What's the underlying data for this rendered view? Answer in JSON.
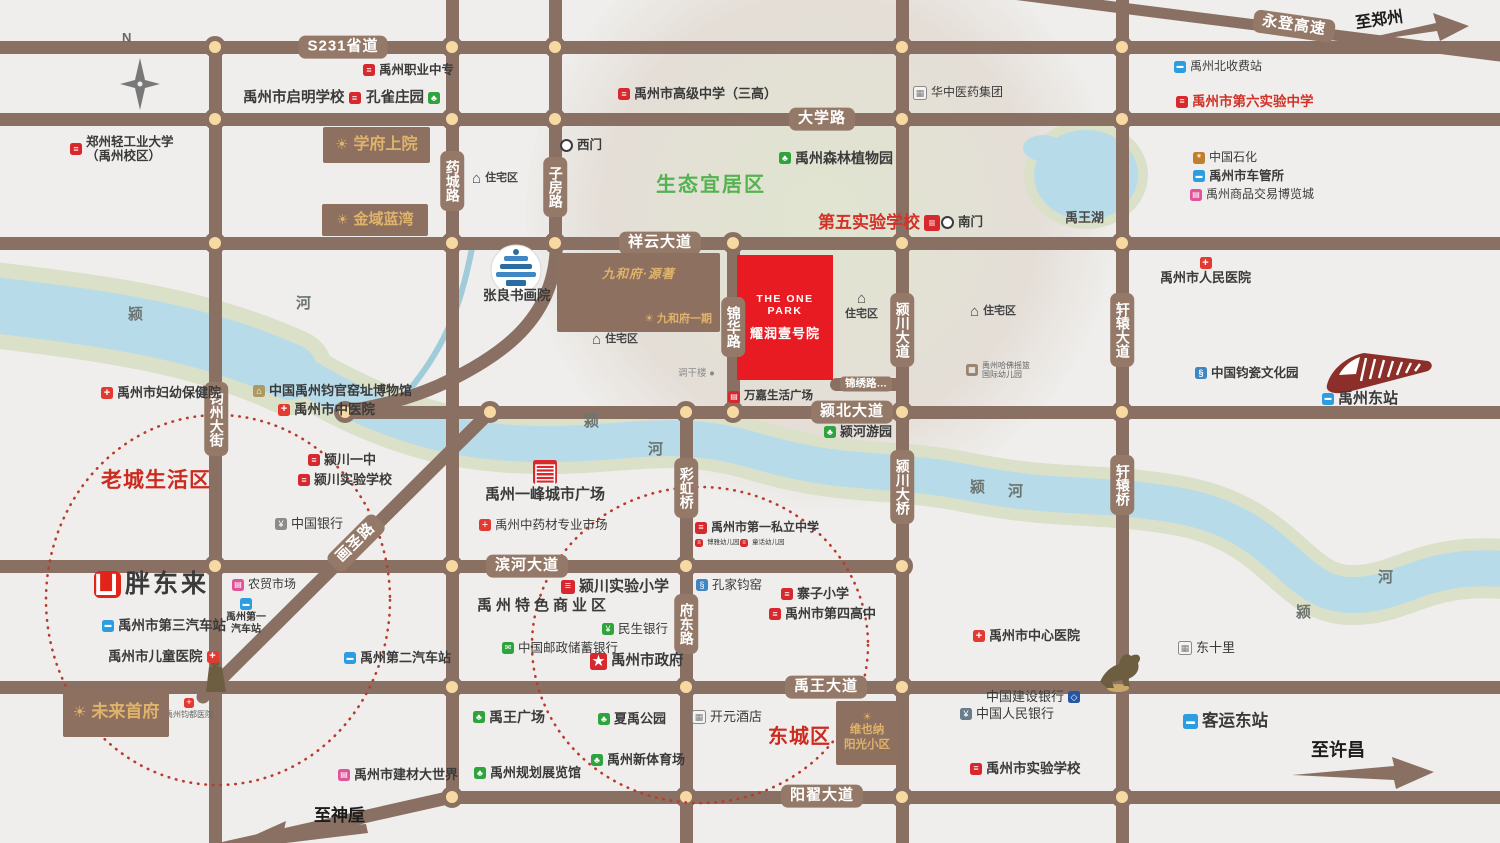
{
  "compass": {
    "label": "N"
  },
  "project": {
    "name_en": "THE ONE PARK",
    "name_cn": "耀润壹号院",
    "x": 737,
    "y": 255,
    "w": 96,
    "h": 125,
    "color": "#e81b23"
  },
  "colors": {
    "road": "#8a7063",
    "node_fill": "#f7d9a2",
    "river": "#b7dbe9",
    "bank": "#dbe0c8",
    "accent_red": "#d7282d",
    "area_red": "#cc2b20",
    "eco_green": "#54b251",
    "gold": "#dfb36a"
  },
  "roads": {
    "horizontal": [
      {
        "id": "s231",
        "y": 47,
        "x1": -10,
        "x2": 1510
      },
      {
        "id": "daxue-road",
        "y": 119,
        "x1": -10,
        "x2": 1510
      },
      {
        "id": "xiangyun-avenue",
        "y": 243,
        "x1": -10,
        "x2": 1510
      },
      {
        "id": "yingbei-avenue",
        "y": 412,
        "x1": 337,
        "x2": 1510
      },
      {
        "id": "binhe-avenue",
        "y": 566,
        "x1": -10,
        "x2": 908
      },
      {
        "id": "yuwang-avenue",
        "y": 687,
        "x1": -10,
        "x2": 1510
      },
      {
        "id": "yangzhai-avenue",
        "y": 797,
        "x1": 444,
        "x2": 1510
      },
      {
        "id": "jinxiu-road",
        "y": 384,
        "x1": 830,
        "x2": 902
      }
    ],
    "vertical": [
      {
        "id": "junzhou-street",
        "x": 215,
        "y1": 40,
        "y2": 853
      },
      {
        "id": "yaocheng-road",
        "x": 452,
        "y1": -10,
        "y2": 797
      },
      {
        "id": "zifang-road",
        "x": 555,
        "y1": -10,
        "y2": 250
      },
      {
        "id": "caihong-fudong-road",
        "x": 686,
        "y1": 412,
        "y2": 853
      },
      {
        "id": "jinhua-road",
        "x": 733,
        "y1": 243,
        "y2": 412
      },
      {
        "id": "yingchuan-avenue",
        "x": 902,
        "y1": -10,
        "y2": 853
      },
      {
        "id": "xuanyuan-avenue",
        "x": 1122,
        "y1": -10,
        "y2": 853
      }
    ],
    "intersections": [
      [
        215,
        47
      ],
      [
        452,
        47
      ],
      [
        555,
        47
      ],
      [
        902,
        47
      ],
      [
        1122,
        47
      ],
      [
        215,
        119
      ],
      [
        452,
        119
      ],
      [
        555,
        119
      ],
      [
        902,
        119
      ],
      [
        1122,
        119
      ],
      [
        215,
        243
      ],
      [
        452,
        243
      ],
      [
        555,
        243
      ],
      [
        733,
        243
      ],
      [
        902,
        243
      ],
      [
        1122,
        243
      ],
      [
        345,
        412
      ],
      [
        490,
        412
      ],
      [
        686,
        412
      ],
      [
        733,
        412
      ],
      [
        902,
        412
      ],
      [
        1122,
        412
      ],
      [
        215,
        566
      ],
      [
        452,
        566
      ],
      [
        686,
        566
      ],
      [
        902,
        566
      ],
      [
        452,
        687
      ],
      [
        686,
        687
      ],
      [
        902,
        687
      ],
      [
        452,
        797
      ],
      [
        686,
        797
      ],
      [
        902,
        797
      ],
      [
        1122,
        797
      ]
    ],
    "labels": [
      {
        "id": "s231-label",
        "text": "S231省道",
        "x": 343,
        "y": 47
      },
      {
        "id": "daxue-road-label",
        "text": "大学路",
        "x": 822,
        "y": 119
      },
      {
        "id": "xiangyun-avenue-label",
        "text": "祥云大道",
        "x": 660,
        "y": 243
      },
      {
        "id": "yingbei-avenue-label",
        "text": "颍北大道",
        "x": 852,
        "y": 412
      },
      {
        "id": "binhe-avenue-label",
        "text": "滨河大道",
        "x": 527,
        "y": 566
      },
      {
        "id": "yuwang-avenue-label",
        "text": "禹王大道",
        "x": 826,
        "y": 687
      },
      {
        "id": "yangzhai-avenue-label",
        "text": "阳翟大道",
        "x": 822,
        "y": 796
      },
      {
        "id": "jinxiu-road-label",
        "text": "锦绣路…",
        "x": 866,
        "y": 384,
        "small": true
      },
      {
        "id": "yaocheng-road-label",
        "text": "药城路",
        "x": 452,
        "y": 181,
        "vertical": true
      },
      {
        "id": "zifang-road-label",
        "text": "子房路",
        "x": 555,
        "y": 187,
        "vertical": true
      },
      {
        "id": "jinhua-road-label",
        "text": "锦华路",
        "x": 733,
        "y": 327,
        "vertical": true
      },
      {
        "id": "junzhou-street-label",
        "text": "钧州大街",
        "x": 216,
        "y": 419,
        "vertical": true
      },
      {
        "id": "yingchuan-avenue-label",
        "text": "颍川大道",
        "x": 902,
        "y": 330,
        "vertical": true
      },
      {
        "id": "yingchuan-bridge-label",
        "text": "颍川大桥",
        "x": 902,
        "y": 487,
        "vertical": true
      },
      {
        "id": "xuanyuan-avenue-label",
        "text": "轩辕大道",
        "x": 1122,
        "y": 330,
        "vertical": true
      },
      {
        "id": "xuanyuan-bridge-label",
        "text": "轩辕桥",
        "x": 1122,
        "y": 485,
        "vertical": true
      },
      {
        "id": "caihong-bridge-label",
        "text": "彩虹桥",
        "x": 686,
        "y": 488,
        "vertical": true
      },
      {
        "id": "fudong-road-label",
        "text": "府东路",
        "x": 686,
        "y": 624,
        "vertical": true
      },
      {
        "id": "huasheng-road-label",
        "text": "画圣路",
        "x": 356,
        "y": 543,
        "rotate": -45
      },
      {
        "id": "yongdeng-expressway-label",
        "text": "永登高速",
        "x": 1294,
        "y": 26,
        "rotate": 8
      }
    ]
  },
  "areas": [
    {
      "id": "eco-livable-area-label",
      "text": "生态宜居区",
      "x": 656,
      "y": 168,
      "fs": 20,
      "c": "#54b251",
      "ls": 2
    },
    {
      "id": "old-town-area-label",
      "text": "老城生活区",
      "x": 101,
      "y": 464,
      "fs": 21,
      "c": "#cc2b20",
      "ls": 1
    },
    {
      "id": "east-city-area-label",
      "text": "东城区",
      "x": 768,
      "y": 720,
      "fs": 20,
      "c": "#cc2b20",
      "ls": 1
    }
  ],
  "blocks": [
    {
      "id": "xuefu-shangyuan-block",
      "lines": [
        "学府上院"
      ],
      "x": 323,
      "y": 127,
      "w": 107,
      "h": 36,
      "fs": 16,
      "layout": "row"
    },
    {
      "id": "jinyu-lanwan-block",
      "lines": [
        "金域蓝湾"
      ],
      "x": 322,
      "y": 204,
      "w": 106,
      "h": 32,
      "fs": 15,
      "layout": "row"
    },
    {
      "id": "weilai-shoufu-block",
      "lines": [
        "未来首府"
      ],
      "x": 63,
      "y": 688,
      "w": 106,
      "h": 49,
      "fs": 17,
      "layout": "row"
    },
    {
      "id": "vienna-sunshine-block",
      "lines": [
        "维也纳",
        "阳光小区"
      ],
      "x": 836,
      "y": 701,
      "w": 62,
      "h": 64,
      "fs": 11.5,
      "layout": "col"
    }
  ],
  "jiuhefu": {
    "id": "jiuhefu-block",
    "x": 557,
    "y": 253,
    "w": 163,
    "h": 79,
    "script": "九和府·源著",
    "sub": "九和府一期"
  },
  "pois": [
    {
      "id": "yuzhou-vocational-school",
      "l": "禹州职业中专",
      "x": 363,
      "y": 63,
      "i": "school",
      "fs": 12.5
    },
    {
      "id": "qiming-school",
      "l": "禹州市启明学校",
      "x": 243,
      "y": 90,
      "i": "school",
      "side": "r",
      "fs": 14.5
    },
    {
      "id": "peacock-manor",
      "l": "孔雀庄园",
      "x": 366,
      "y": 90,
      "i": "tree",
      "side": "r",
      "fs": 14.5
    },
    {
      "id": "zhengzhou-light-industry-university",
      "l": "郑州轻工业大学\n（禹州校区）",
      "x": 70,
      "y": 135,
      "i": "school",
      "fs": 12.5
    },
    {
      "id": "yuzhou-senior-high-school",
      "l": "禹州市高级中学（三高）",
      "x": 618,
      "y": 87,
      "i": "school",
      "fs": 13
    },
    {
      "id": "huazhong-pharma-group",
      "l": "华中医药集团",
      "x": 913,
      "y": 86,
      "i": "building",
      "fs": 12,
      "bold": false
    },
    {
      "id": "west-gate",
      "l": "西门",
      "x": 560,
      "y": 138,
      "i": "gate",
      "fs": 12.5
    },
    {
      "id": "forest-botanical-garden",
      "l": "禹州森林植物园",
      "x": 779,
      "y": 150,
      "i": "tree",
      "fs": 14
    },
    {
      "id": "fifth-experimental-school",
      "l": "第五实验学校",
      "x": 818,
      "y": 213,
      "i": "school",
      "side": "r",
      "fs": 17,
      "c": "#d23227",
      "isz": 16
    },
    {
      "id": "south-gate",
      "l": "南门",
      "x": 941,
      "y": 215,
      "i": "gate",
      "fs": 12.5
    },
    {
      "id": "yuwang-lake-label",
      "l": "禹王湖",
      "x": 1065,
      "y": 211,
      "fs": 13,
      "c": "#4a4a4a"
    },
    {
      "id": "north-toll-station",
      "l": "禹州北收费站",
      "x": 1174,
      "y": 60,
      "i": "toll",
      "fs": 12,
      "bold": false
    },
    {
      "id": "sixth-experimental-middle-school",
      "l": "禹州市第六实验中学",
      "x": 1176,
      "y": 94,
      "i": "school",
      "fs": 13.5,
      "c": "#d23227"
    },
    {
      "id": "sinopec",
      "l": "中国石化",
      "x": 1193,
      "y": 151,
      "i": "petrol",
      "fs": 12,
      "bold": false
    },
    {
      "id": "vehicle-administration",
      "l": "禹州市车管所",
      "x": 1193,
      "y": 169,
      "i": "traffic",
      "fs": 12.5
    },
    {
      "id": "commodity-expo-city",
      "l": "禹州商品交易博览城",
      "x": 1190,
      "y": 188,
      "i": "expo",
      "fs": 12,
      "bold": false
    },
    {
      "id": "peoples-hospital",
      "l": "禹州市人民医院",
      "x": 1160,
      "y": 257,
      "i": "hospital",
      "side": "t",
      "fs": 13
    },
    {
      "id": "junci-culture-park",
      "l": "中国钧瓷文化园",
      "x": 1195,
      "y": 366,
      "i": "vase",
      "fs": 12.5
    },
    {
      "id": "yuzhou-east-station",
      "l": "禹州东站",
      "x": 1322,
      "y": 390,
      "i": "train",
      "fs": 15
    },
    {
      "id": "residential-area-1",
      "l": "住宅区",
      "x": 472,
      "y": 171,
      "i": "house",
      "fs": 11,
      "c": "#444"
    },
    {
      "id": "residential-area-2",
      "l": "住宅区",
      "x": 592,
      "y": 332,
      "i": "house",
      "fs": 11,
      "c": "#444"
    },
    {
      "id": "residential-area-3",
      "l": "住宅区",
      "x": 845,
      "y": 291,
      "i": "house",
      "side": "t",
      "fs": 11,
      "c": "#444"
    },
    {
      "id": "residential-area-4",
      "l": "住宅区",
      "x": 970,
      "y": 304,
      "i": "house",
      "fs": 11,
      "c": "#444"
    },
    {
      "id": "zhangliang-academy",
      "l": "张良书画院",
      "x": 483,
      "y": 288,
      "fs": 13.5
    },
    {
      "id": "diaoganlou",
      "l": "调干楼 ●",
      "x": 678,
      "y": 369,
      "fs": 9.5,
      "c": "#8a8a8a",
      "bold": false
    },
    {
      "id": "wanjia-life-plaza",
      "l": "万嘉生活广场",
      "x": 728,
      "y": 390,
      "i": "mall",
      "fs": 11.5
    },
    {
      "id": "yinghe-riverside-park",
      "l": "颍河游园",
      "x": 824,
      "y": 425,
      "i": "tree",
      "fs": 13
    },
    {
      "id": "harvard-cradle-kindergarten",
      "l": "禹州哈佛摇篮\n国际幼儿园",
      "x": 966,
      "y": 361,
      "i": "kindergarten",
      "fs": 8,
      "c": "#666",
      "bold": false
    },
    {
      "id": "maternal-child-health-hospital",
      "l": "禹州市妇幼保健院",
      "x": 101,
      "y": 386,
      "i": "hospital",
      "fs": 13
    },
    {
      "id": "jun-kiln-site-museum",
      "l": "中国禹州钧官窑址博物馆",
      "x": 253,
      "y": 384,
      "i": "museum",
      "fs": 13
    },
    {
      "id": "tcm-hospital",
      "l": "禹州市中医院",
      "x": 278,
      "y": 402,
      "i": "hospital",
      "fs": 13.5
    },
    {
      "id": "yingchuan-no1-middle-school",
      "l": "颍川一中",
      "x": 308,
      "y": 453,
      "i": "school",
      "fs": 13
    },
    {
      "id": "yingchuan-experimental-school",
      "l": "颍川实验学校",
      "x": 298,
      "y": 473,
      "i": "school",
      "fs": 13
    },
    {
      "id": "bank-of-china",
      "l": "中国银行",
      "x": 275,
      "y": 517,
      "i": "boc",
      "fs": 13,
      "bold": false
    },
    {
      "id": "farmers-market",
      "l": "农贸市场",
      "x": 232,
      "y": 578,
      "i": "market",
      "fs": 12,
      "bold": false
    },
    {
      "id": "pangdonglai",
      "l": "胖东来",
      "x": 94,
      "y": 570,
      "i": "cart",
      "fs": 25,
      "isz": 27,
      "ls": 3
    },
    {
      "id": "no1-bus-station",
      "l": "禹州第一\n汽车站",
      "x": 226,
      "y": 598,
      "i": "bus",
      "side": "t",
      "fs": 10
    },
    {
      "id": "no3-bus-station",
      "l": "禹州市第三汽车站",
      "x": 102,
      "y": 618,
      "i": "bus",
      "fs": 13.5
    },
    {
      "id": "children-hospital",
      "l": "禹州市儿童医院",
      "x": 108,
      "y": 649,
      "i": "hospital",
      "side": "r",
      "fs": 13.5
    },
    {
      "id": "no2-bus-station",
      "l": "禹州第二汽车站",
      "x": 344,
      "y": 651,
      "i": "bus",
      "fs": 13
    },
    {
      "id": "jundu-hospital",
      "l": "禹州钧都医院",
      "x": 165,
      "y": 698,
      "i": "hospital",
      "side": "t",
      "fs": 8,
      "c": "#666",
      "bold": false,
      "isz": 10
    },
    {
      "id": "yifeng-city-plaza",
      "l": "禹州一峰城市广场",
      "x": 485,
      "y": 460,
      "i": "plaza",
      "side": "t",
      "fs": 15,
      "isz": 24
    },
    {
      "id": "tcm-materials-market",
      "l": "禹州中药材专业市场",
      "x": 479,
      "y": 518,
      "i": "hospital",
      "fs": 12.5,
      "bold": false
    },
    {
      "id": "yingchuan-experimental-primary",
      "l": "颍川实验小学",
      "x": 561,
      "y": 578,
      "i": "school",
      "fs": 15,
      "isz": 14
    },
    {
      "id": "specialty-commercial-area",
      "l": "禹州特色商业区",
      "x": 477,
      "y": 597,
      "fs": 15,
      "ls": 4
    },
    {
      "id": "minsheng-bank",
      "l": "民生银行",
      "x": 602,
      "y": 622,
      "i": "bank",
      "fs": 12.5,
      "bold": false
    },
    {
      "id": "postal-savings-bank",
      "l": "中国邮政储蓄银行",
      "x": 502,
      "y": 641,
      "i": "post",
      "fs": 12.5,
      "bold": false
    },
    {
      "id": "city-government",
      "l": "禹州市政府",
      "x": 590,
      "y": 653,
      "i": "gov",
      "fs": 14.5,
      "isz": 17
    },
    {
      "id": "kongjia-kiln",
      "l": "孔家钧窑",
      "x": 696,
      "y": 578,
      "i": "vase",
      "fs": 12.5,
      "bold": false
    },
    {
      "id": "zhaizi-primary-school",
      "l": "寨子小学",
      "x": 781,
      "y": 587,
      "i": "school",
      "fs": 13
    },
    {
      "id": "no4-high-school",
      "l": "禹州市第四高中",
      "x": 769,
      "y": 607,
      "i": "school",
      "fs": 13
    },
    {
      "id": "no1-private-middle-school",
      "l": "禹州市第一私立中学",
      "x": 695,
      "y": 521,
      "i": "school",
      "fs": 12
    },
    {
      "id": "kindergarten-1",
      "l": "博雅幼儿园",
      "x": 695,
      "y": 539,
      "i": "school",
      "fs": 6.5,
      "bold": false,
      "isz": 8
    },
    {
      "id": "kindergarten-2",
      "l": "童话幼儿园",
      "x": 740,
      "y": 539,
      "i": "school",
      "fs": 6.5,
      "bold": false,
      "isz": 8
    },
    {
      "id": "kaiyuan-hotel",
      "l": "开元酒店",
      "x": 692,
      "y": 710,
      "i": "building",
      "fs": 13,
      "bold": false
    },
    {
      "id": "ccb-bank",
      "l": "中国建设银行",
      "x": 986,
      "y": 690,
      "i": "ccb",
      "side": "r",
      "fs": 13,
      "bold": false
    },
    {
      "id": "pboc-bank",
      "l": "中国人民银行",
      "x": 960,
      "y": 707,
      "i": "pboc",
      "fs": 13,
      "bold": false
    },
    {
      "id": "central-hospital",
      "l": "禹州市中心医院",
      "x": 973,
      "y": 629,
      "i": "hospital",
      "fs": 13
    },
    {
      "id": "experimental-school",
      "l": "禹州市实验学校",
      "x": 970,
      "y": 761,
      "i": "school",
      "fs": 13.5
    },
    {
      "id": "dongshili",
      "l": "东十里",
      "x": 1178,
      "y": 641,
      "i": "building",
      "fs": 13,
      "bold": false
    },
    {
      "id": "east-bus-station",
      "l": "客运东站",
      "x": 1183,
      "y": 712,
      "i": "bus",
      "fs": 16.5,
      "isz": 15
    },
    {
      "id": "planning-exhibition-hall",
      "l": "禹州规划展览馆",
      "x": 474,
      "y": 766,
      "i": "tree",
      "fs": 13
    },
    {
      "id": "yuwang-square",
      "l": "禹王广场",
      "x": 473,
      "y": 709,
      "i": "tree",
      "fs": 14
    },
    {
      "id": "xiayu-park",
      "l": "夏禹公园",
      "x": 598,
      "y": 712,
      "i": "tree",
      "fs": 13
    },
    {
      "id": "new-stadium",
      "l": "禹州新体育场",
      "x": 591,
      "y": 753,
      "i": "tree",
      "fs": 13
    },
    {
      "id": "building-materials-world",
      "l": "禹州市建材大世界",
      "x": 338,
      "y": 768,
      "i": "market",
      "fs": 13
    }
  ],
  "river_labels": [
    {
      "t": "颍",
      "x": 128,
      "y": 303
    },
    {
      "t": "河",
      "x": 296,
      "y": 292
    },
    {
      "t": "颍",
      "x": 584,
      "y": 410
    },
    {
      "t": "河",
      "x": 648,
      "y": 438
    },
    {
      "t": "颍",
      "x": 970,
      "y": 476
    },
    {
      "t": "河",
      "x": 1008,
      "y": 480
    },
    {
      "t": "河",
      "x": 1378,
      "y": 566
    },
    {
      "t": "颍",
      "x": 1296,
      "y": 601
    }
  ],
  "arrows": [
    {
      "id": "to-zhengzhou-label",
      "text": "至郑州",
      "x": 1355,
      "y": 6,
      "fs": 16,
      "rot": -8
    },
    {
      "id": "to-xuchang-label",
      "text": "至许昌",
      "x": 1311,
      "y": 736,
      "fs": 18
    },
    {
      "id": "to-shenhou-label",
      "text": "至神垕",
      "x": 314,
      "y": 801,
      "fs": 17
    }
  ]
}
